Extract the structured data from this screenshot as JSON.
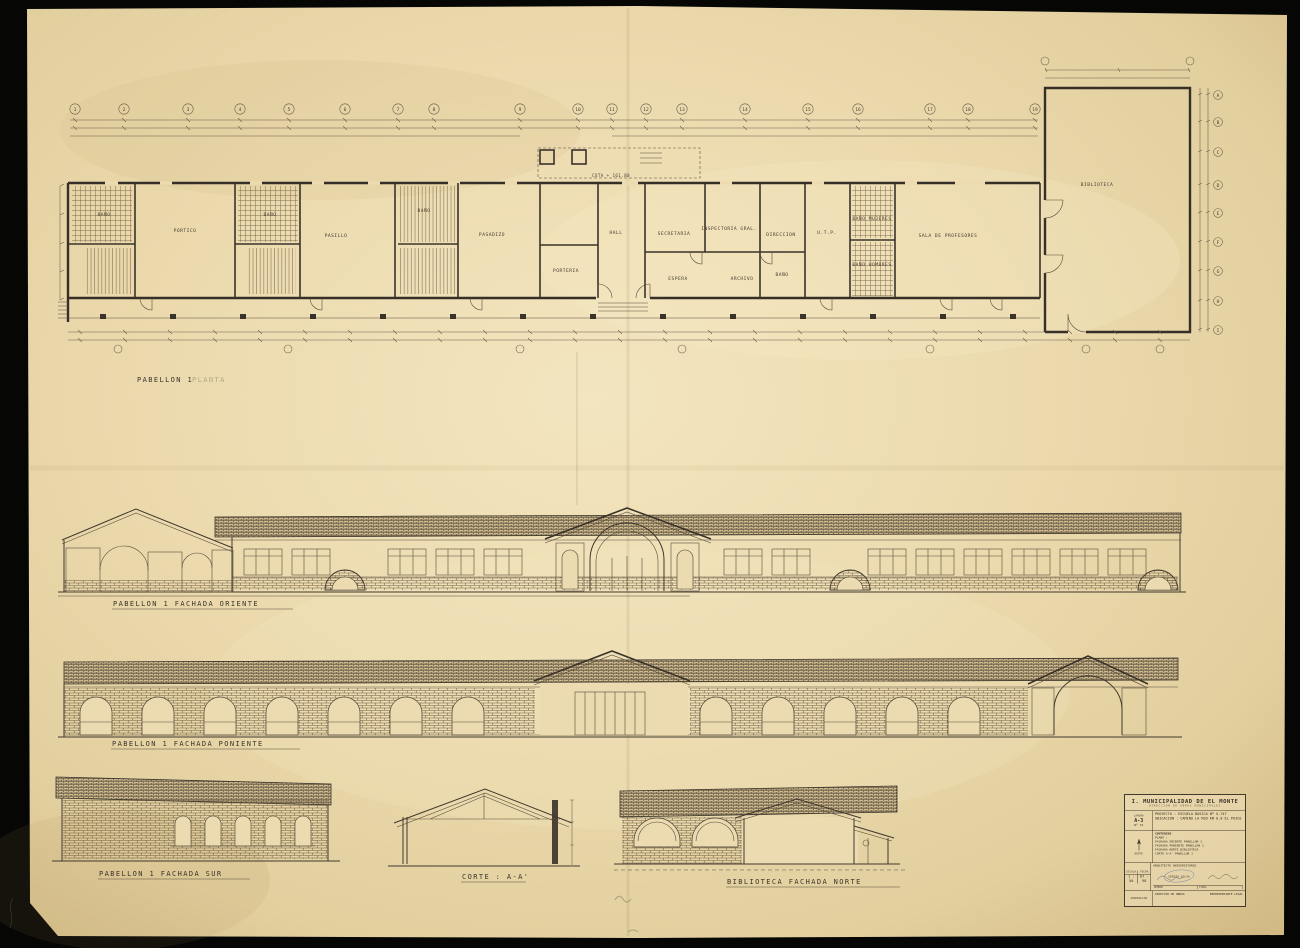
{
  "palette": {
    "paper": "#e8d6a8",
    "ink": "#3a332a",
    "stamp_blue": "#5b79ad",
    "scan_bg": "#060605"
  },
  "sheet": {
    "captions": {
      "plan": "PABELLON 1",
      "plan_suffix": "PLANTA",
      "oriente": "PABELLON  1   FACHADA  ORIENTE",
      "poniente": "PABELLON  1   FACHADA  PONIENTE",
      "sur": "PABELLON  1   FACHADA  SUR",
      "corte": "CORTE : A-A'",
      "biblioteca": "BIBLIOTECA  FACHADA   NORTE"
    },
    "plan": {
      "cota_note": "COTA + 161.80",
      "rooms": [
        {
          "label": "BAÑO",
          "x": 104,
          "y": 216
        },
        {
          "label": "PORTICO",
          "x": 185,
          "y": 232
        },
        {
          "label": "BAÑO",
          "x": 270,
          "y": 216
        },
        {
          "label": "PASILLO",
          "x": 336,
          "y": 237
        },
        {
          "label": "BAÑO",
          "x": 424,
          "y": 212
        },
        {
          "label": "PASADIZO",
          "x": 492,
          "y": 236
        },
        {
          "label": "PORTERIA",
          "x": 566,
          "y": 272
        },
        {
          "label": "HALL",
          "x": 616,
          "y": 234
        },
        {
          "label": "SECRETARIA",
          "x": 674,
          "y": 235
        },
        {
          "label": "INSPECTORIA GRAL.",
          "x": 729,
          "y": 230
        },
        {
          "label": "DIRECCION",
          "x": 781,
          "y": 236
        },
        {
          "label": "U.T.P.",
          "x": 827,
          "y": 234
        },
        {
          "label": "BAÑO MUJERES",
          "x": 872,
          "y": 220
        },
        {
          "label": "ESPERA",
          "x": 678,
          "y": 280
        },
        {
          "label": "ARCHIVO",
          "x": 742,
          "y": 280
        },
        {
          "label": "BAÑO",
          "x": 782,
          "y": 276
        },
        {
          "label": "BAÑO HOMBRES",
          "x": 872,
          "y": 266
        },
        {
          "label": "SALA DE PROFESORES",
          "x": 948,
          "y": 237
        },
        {
          "label": "BIBLIOTECA",
          "x": 1097,
          "y": 186
        }
      ],
      "grid_top": [
        {
          "x": 75,
          "label": "1"
        },
        {
          "x": 124,
          "label": "2"
        },
        {
          "x": 188,
          "label": "3"
        },
        {
          "x": 240,
          "label": "4"
        },
        {
          "x": 289,
          "label": "5"
        },
        {
          "x": 345,
          "label": "6"
        },
        {
          "x": 398,
          "label": "7"
        },
        {
          "x": 434,
          "label": "8"
        },
        {
          "x": 520,
          "label": "9"
        },
        {
          "x": 578,
          "label": "10"
        },
        {
          "x": 612,
          "label": "11"
        },
        {
          "x": 646,
          "label": "12"
        },
        {
          "x": 682,
          "label": "13"
        },
        {
          "x": 745,
          "label": "14"
        },
        {
          "x": 808,
          "label": "15"
        },
        {
          "x": 858,
          "label": "16"
        },
        {
          "x": 930,
          "label": "17"
        },
        {
          "x": 968,
          "label": "18"
        },
        {
          "x": 1035,
          "label": "19"
        }
      ],
      "grid_right": [
        {
          "y": 95,
          "label": "A"
        },
        {
          "y": 122,
          "label": "B"
        },
        {
          "y": 152,
          "label": "C"
        },
        {
          "y": 185,
          "label": "D"
        },
        {
          "y": 213,
          "label": "E"
        },
        {
          "y": 242,
          "label": "F"
        },
        {
          "y": 271,
          "label": "G"
        },
        {
          "y": 301,
          "label": "H"
        },
        {
          "y": 330,
          "label": "I"
        }
      ]
    },
    "title_block": {
      "municipality": "I. MUNICIPALIDAD  DE  EL  MONTE",
      "department": "DIRECCION  DE  OBRAS  MUNICIPALES",
      "lamina_label": "LAMINA",
      "lamina_value": "A-3",
      "sheet_no": "Nº 15",
      "proyecto": "PROYECTO : ESCUELA BASICA Nº G-747",
      "ubicacion": "UBICACION : CAMINO LA RED KM 0.8  EL PAICO",
      "contenido_label": "CONTENIDO",
      "plano_label": "PLANO :",
      "contents": [
        "FACHADA ORIENTE  PABELLON 1",
        "FACHADA PONIENTE PABELLON 1",
        "FACHADA NORTE  BIBLIOTECA",
        "CORTE A-A'  PABELLON 1"
      ],
      "norte_label": "NORTE",
      "escala_label": "ESCALA",
      "escala_value": "1 : 50",
      "fecha_label": "FECHA",
      "fecha_value": "07 - 98",
      "arquitecto_row": "ARQUITECTO  UNIVERSITARIO",
      "stamp_name": "SERGIO SILVA",
      "sig_labels": [
        "NOMBRE",
        "FIRMA"
      ],
      "aprobacion_label": "APROBACION",
      "approval_left": "DIRECTOR DE OBRAS",
      "approval_right": "REPRESENTANTE LEGAL"
    }
  }
}
